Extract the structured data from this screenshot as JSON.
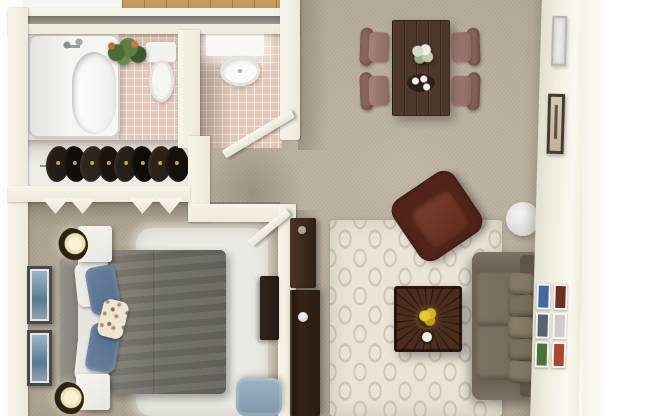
{
  "scene": {
    "kind": "3D rendered apartment floor plan, top-down view",
    "unit_type": "one-bedroom / one-bath apartment",
    "visible_text": ""
  },
  "palette": {
    "outer_background": "#ffffff",
    "walls": "#f2eee0",
    "wall_groove": "#8a8780",
    "living_carpet": "#b6ab9a",
    "bedroom_carpet": "#aba08e",
    "bathroom_tile": "#e2c8bb",
    "wood_floor": "#c49a5f",
    "trellis_rug": "#e9e4d6",
    "trellis_pattern": "#cfc7b4",
    "bedroom_shag_rug": "#ebe9e3",
    "sofa": "#6f6556",
    "armchair": "#522419",
    "dining_table": "#4e372b",
    "dining_chairs": "#8a665c",
    "coffee_table": "#42271a",
    "bed_comforter": "#6f6c66",
    "blue_pillows": "#5f7795",
    "entry_door": "#2a1a10",
    "storage_bench": "#8ea7b8",
    "flowers_yellow": "#e0bc2a",
    "lamp_glow": "#faf2d2"
  },
  "labels": {
    "floor_plan": "3D apartment floor plan (top view)",
    "bathtub": "Bathtub",
    "toilet": "Toilet",
    "sink": "Vanity sink",
    "plant": "Potted plant",
    "closet_clothes": "Closet with hanging clothes",
    "bifold_door": "Bi-fold closet door",
    "bathroom_door": "Bathroom door (open)",
    "bedroom_door": "Bedroom door (open)",
    "bed": "Queen bed with gray comforter",
    "headboard": "Headboard",
    "pillow": "Pillow",
    "nightstand": "Nightstand",
    "lamp": "Table lamp",
    "wall_art": "Framed wall art",
    "dresser": "Dresser",
    "bench": "Blue storage bench",
    "shag_rug": "White shag rug",
    "dining_table": "Dining table",
    "dining_chair": "Dining chair",
    "vase": "Flower vase",
    "tray": "Serving tray with cups",
    "area_rug": "Cream trellis area rug",
    "armchair": "Leather armchair",
    "side_table": "Round side table",
    "sofa": "Sofa",
    "sofa_pillow": "Sofa back cushion",
    "coffee_table": "Square coffee table",
    "flowers": "Yellow flower centerpiece",
    "console": "Console table",
    "entry_door": "Entry door",
    "door_knob": "Door knob",
    "picture_frame": "Picture frame",
    "gallery": "Gallery picture frames"
  },
  "rooms": [
    {
      "name": "bathroom",
      "furniture": [
        "bathtub",
        "toilet",
        "potted plant",
        "tile floor"
      ]
    },
    {
      "name": "vanity-room",
      "furniture": [
        "vanity counter",
        "sink",
        "open door"
      ]
    },
    {
      "name": "closet",
      "furniture": [
        "hanging clothes",
        "bi-fold doors"
      ]
    },
    {
      "name": "bedroom",
      "furniture": [
        "queen bed",
        "2 nightstands",
        "2 table lamps",
        "2 framed artworks",
        "dresser",
        "blue storage bench",
        "white shag rug"
      ]
    },
    {
      "name": "dining-area",
      "furniture": [
        "dark wood dining table",
        "4 upholstered chairs",
        "flower vase",
        "serving tray"
      ]
    },
    {
      "name": "living-room",
      "furniture": [
        "sofa",
        "leather armchair",
        "coffee table",
        "trellis rug",
        "round side table",
        "console table",
        "gallery frames",
        "2 wall frames"
      ]
    },
    {
      "name": "entry",
      "furniture": [
        "entry door"
      ]
    }
  ]
}
